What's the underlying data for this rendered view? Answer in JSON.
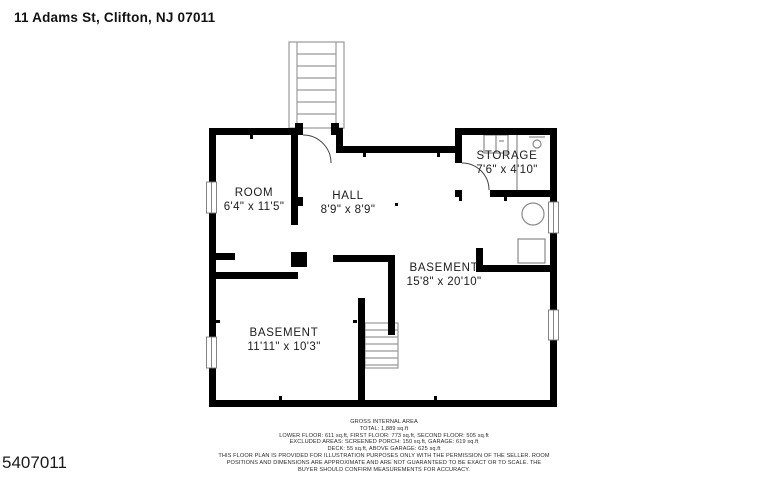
{
  "header": {
    "address": "11 Adams St, Clifton, NJ 07011"
  },
  "photo_id": "5407011",
  "floor_plan": {
    "rooms": [
      {
        "name": "ROOM",
        "dimensions": "6'4\" x 11'5\""
      },
      {
        "name": "HALL",
        "dimensions": "8'9\" x 8'9\""
      },
      {
        "name": "STORAGE",
        "dimensions": "7'6\" x 4'10\""
      },
      {
        "name": "BASEMENT",
        "dimensions": "15'8\" x 20'10\""
      },
      {
        "name": "BASEMENT",
        "dimensions": "11'11\" x 10'3\""
      }
    ],
    "features": [
      "upper-staircase",
      "lower-staircase",
      "storage-closet",
      "water-tank",
      "utility-unit",
      "windows",
      "door-swings"
    ]
  },
  "footer": {
    "area_title": "GROSS INTERNAL AREA",
    "total": "TOTAL: 1,889 sq.ft",
    "floors": "LOWER FLOOR: 611 sq.ft, FIRST FLOOR: 773 sq.ft, SECOND FLOOR: 505 sq.ft",
    "excluded": "EXCLUDED AREAS: SCREENED PORCH: 150 sq.ft, GARAGE: 619 sq.ft",
    "deck": "DECK: 55 sq.ft, ABOVE GARAGE: 625 sq.ft",
    "disclaimer_1": "THIS FLOOR PLAN IS PROVIDED FOR ILLUSTRATION PURPOSES ONLY WITH THE PERMISSION OF THE SELLER. ROOM",
    "disclaimer_2": "POSITIONS AND DIMENSIONS ARE APPROXIMATE AND ARE NOT GUARANTEED TO BE EXACT OR TO SCALE. THE",
    "disclaimer_3": "BUYER SHOULD CONFIRM MEASUREMENTS FOR ACCURACY."
  },
  "colors": {
    "wall": "#000000",
    "thin_line": "#999999",
    "text": "#1c1c1c",
    "background": "#ffffff"
  }
}
